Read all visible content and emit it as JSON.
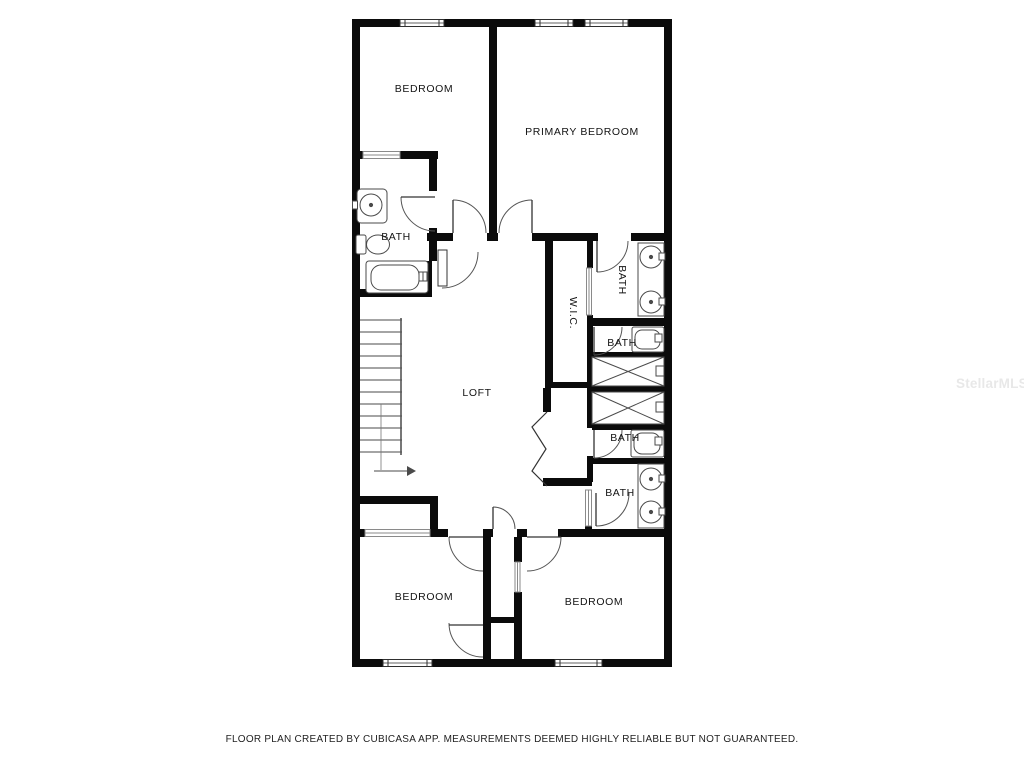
{
  "rooms": {
    "bedroom_top_left": {
      "label": "BEDROOM"
    },
    "primary_bedroom": {
      "label": "PRIMARY BEDROOM"
    },
    "bath_top_left": {
      "label": "BATH"
    },
    "wic": {
      "label": "W.I.C."
    },
    "bath_ensuite_sinks": {
      "label": "BATH"
    },
    "bath_ensuite_tub": {
      "label": "BATH"
    },
    "bath_hall_tub": {
      "label": "BATH"
    },
    "bath_hall_sinks": {
      "label": "BATH"
    },
    "loft": {
      "label": "LOFT"
    },
    "bedroom_bottom_left": {
      "label": "BEDROOM"
    },
    "bedroom_bottom_right": {
      "label": "BEDROOM"
    }
  },
  "watermark": {
    "text": "StellarMLS"
  },
  "footer": {
    "disclaimer": "FLOOR PLAN CREATED BY CUBICASA APP. MEASUREMENTS DEEMED HIGHLY RELIABLE BUT NOT GUARANTEED."
  },
  "fixture_icons": [
    "stairs",
    "bathtub",
    "toilet",
    "round-sink",
    "vanity-counter",
    "closet-cross",
    "door-swing",
    "sliding-door",
    "accordion-door",
    "window",
    "direction-arrow"
  ],
  "colors": {
    "wall": "#0b0b0b",
    "line": "#3f3f3f",
    "door": "#555555",
    "background": "#ffffff",
    "label": "#141414",
    "watermark": "#e8e8e8",
    "disclaimer": "#1f1f1f"
  }
}
